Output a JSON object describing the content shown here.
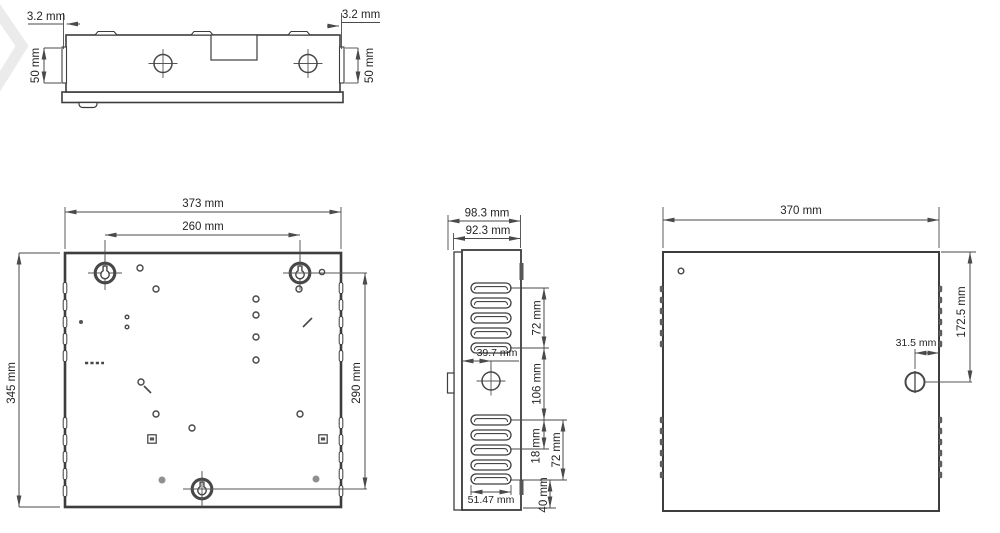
{
  "drawing": {
    "kind": "enclosure dimensional drawing",
    "unit": "mm"
  },
  "top_view": {
    "lip_left": "3.2 mm",
    "lip_right": "3.2 mm",
    "side_height_left": "50 mm",
    "side_height_right": "50 mm"
  },
  "front_view": {
    "overall_width": "373 mm",
    "keyhole_spacing_horizontal": "260 mm",
    "overall_height": "345 mm",
    "keyhole_spacing_vertical": "290 mm"
  },
  "side_view": {
    "depth_overall": "98.3 mm",
    "depth_body": "92.3 mm",
    "vent_upper_span": "72 mm",
    "knockout_offset": "39.7 mm",
    "vent_group_gap": "106 mm",
    "louver_pitch": "18 mm",
    "vent_lower_span": "72 mm",
    "louver_width": "51.47 mm",
    "bottom_offset": "40 mm"
  },
  "door_view": {
    "overall_width": "370 mm",
    "lock_from_top": "172.5 mm",
    "lock_from_edge": "31.5 mm"
  },
  "colors": {
    "line": "#474747",
    "outline": "#3d3d3d",
    "text": "#242424",
    "watermark": "#ebebeb",
    "background": "#ffffff"
  }
}
